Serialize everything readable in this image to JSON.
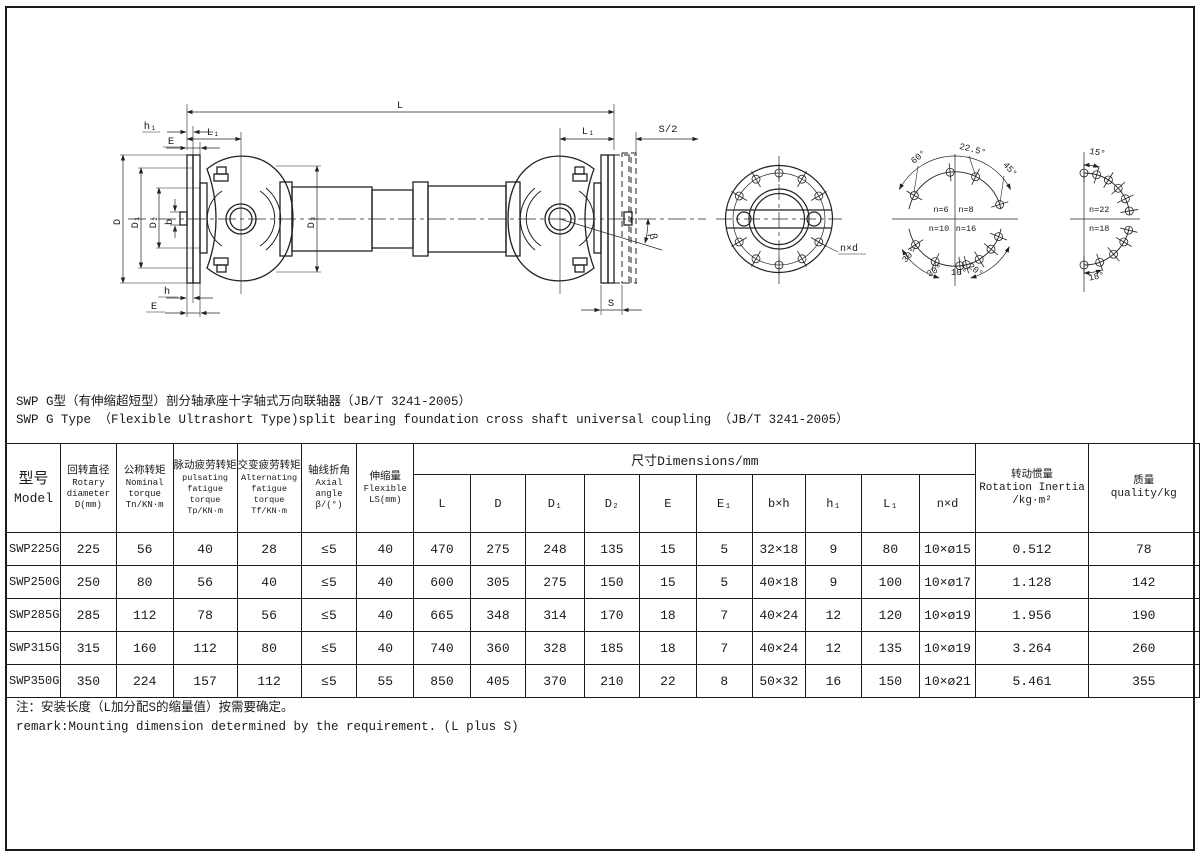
{
  "title": {
    "line_zh": "SWP G型（有伸缩超短型）剖分轴承座十字轴式万向联轴器（JB/T 3241-2005）",
    "line_en": "SWP G Type （Flexible Ultrashort Type)split bearing foundation cross shaft universal coupling （JB/T 3241-2005）"
  },
  "note": {
    "line_zh": "注：安装长度（L加分配S的缩量值）按需要确定。",
    "line_en": "remark:Mounting dimension determined by the requirement. (L plus S)"
  },
  "table": {
    "dim_span": "尺寸Dimensions/mm",
    "headers_left": [
      {
        "zh": "型号",
        "en": "Model",
        "sym": ""
      },
      {
        "zh": "回转直径",
        "en": "Rotary diameter",
        "sym": "D(mm)"
      },
      {
        "zh": "公称转矩",
        "en": "Nominal torque",
        "sym": "Tn/KN·m"
      },
      {
        "zh": "脉动疲劳转矩",
        "en": "pulsating fatigue torque",
        "sym": "Tp/KN·m"
      },
      {
        "zh": "交变疲劳转矩",
        "en": "Alternating fatigue torque",
        "sym": "Tf/KN·m"
      },
      {
        "zh": "轴线折角",
        "en": "Axial angle",
        "sym": "β/(°)"
      },
      {
        "zh": "伸缩量",
        "en": "Flexible",
        "sym": "LS(mm)"
      }
    ],
    "dim_cols": [
      "L",
      "D",
      "D₁",
      "D₂",
      "E",
      "E₁",
      "b×h",
      "h₁",
      "L₁",
      "n×d"
    ],
    "headers_right": [
      {
        "zh": "转动惯量",
        "en": "Rotation Inertia",
        "sym": "/kg·m²"
      },
      {
        "zh": "质量",
        "en": "quality/kg",
        "sym": ""
      }
    ],
    "rows": [
      [
        "SWP225G",
        "225",
        "56",
        "40",
        "28",
        "≤5",
        "40",
        "470",
        "275",
        "248",
        "135",
        "15",
        "5",
        "32×18",
        "9",
        "80",
        "10×ø15",
        "0.512",
        "78"
      ],
      [
        "SWP250G",
        "250",
        "80",
        "56",
        "40",
        "≤5",
        "40",
        "600",
        "305",
        "275",
        "150",
        "15",
        "5",
        "40×18",
        "9",
        "100",
        "10×ø17",
        "1.128",
        "142"
      ],
      [
        "SWP285G",
        "285",
        "112",
        "78",
        "56",
        "≤5",
        "40",
        "665",
        "348",
        "314",
        "170",
        "18",
        "7",
        "40×24",
        "12",
        "120",
        "10×ø19",
        "1.956",
        "190"
      ],
      [
        "SWP315G",
        "315",
        "160",
        "112",
        "80",
        "≤5",
        "40",
        "740",
        "360",
        "328",
        "185",
        "18",
        "7",
        "40×24",
        "12",
        "135",
        "10×ø19",
        "3.264",
        "260"
      ],
      [
        "SWP350G",
        "350",
        "224",
        "157",
        "112",
        "≤5",
        "55",
        "850",
        "405",
        "370",
        "210",
        "22",
        "8",
        "50×32",
        "16",
        "150",
        "10×ø21",
        "5.461",
        "355"
      ]
    ]
  },
  "drawing": {
    "labels": {
      "L": "L",
      "h1": "h₁",
      "L1_left": "L₁",
      "E_top": "E",
      "D": "D",
      "D1": "D₁",
      "D2": "D₂",
      "b": "b",
      "D3": "D₃",
      "h": "h",
      "E_bottom": "E",
      "L1_right": "L₁",
      "S_half": "S/2",
      "S": "S",
      "beta": "β",
      "n_x_d": "n×d",
      "a22_5": "22.5°",
      "a60": "60°",
      "a45": "45°",
      "n6": "n=6",
      "n8": "n=8",
      "n10": "n=10",
      "n16": "n=16",
      "a30a": "30°",
      "a30b": "30°",
      "a10": "10°",
      "a20": "20°",
      "a15": "15°",
      "n22": "n=22",
      "n18": "n=18",
      "a18": "18°"
    }
  }
}
